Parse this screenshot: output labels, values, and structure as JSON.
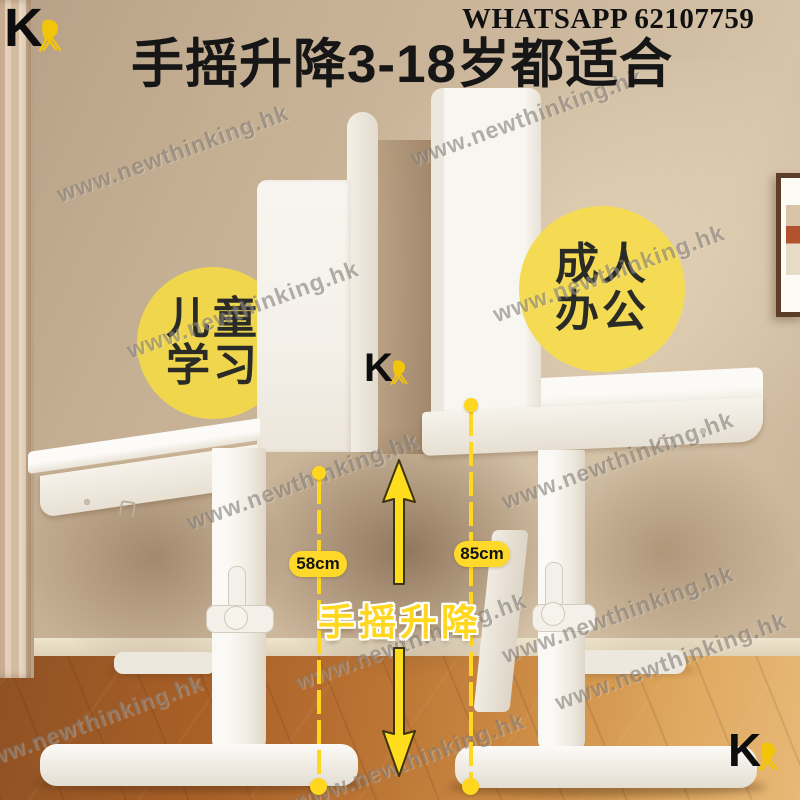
{
  "brand": {
    "mark": "K"
  },
  "header": {
    "whatsapp": "WHATSAPP 62107759",
    "title": "手摇升降3-18岁都适合"
  },
  "badges": {
    "children": {
      "line1": "儿童",
      "line2": "学习"
    },
    "adult": {
      "line1": "成人",
      "line2": "办公"
    }
  },
  "measurements": {
    "desk_left_height": "58cm",
    "desk_right_height": "85cm",
    "mechanism_label": "手摇升降"
  },
  "watermark": {
    "text": "www.newthinking.hk"
  },
  "icons": {
    "chair": "chair-icon",
    "arrow_up": "arrow-up-icon",
    "arrow_down": "arrow-down-icon"
  },
  "colors": {
    "accent_yellow": "#FFD71E",
    "badge_yellow": "#F2D950",
    "pill_yellow": "#FFD929",
    "title_black": "#161616",
    "chair_gold": "#F3C50A",
    "wall_beige": "#CDB89D",
    "floor_brown": "#BB7534"
  }
}
